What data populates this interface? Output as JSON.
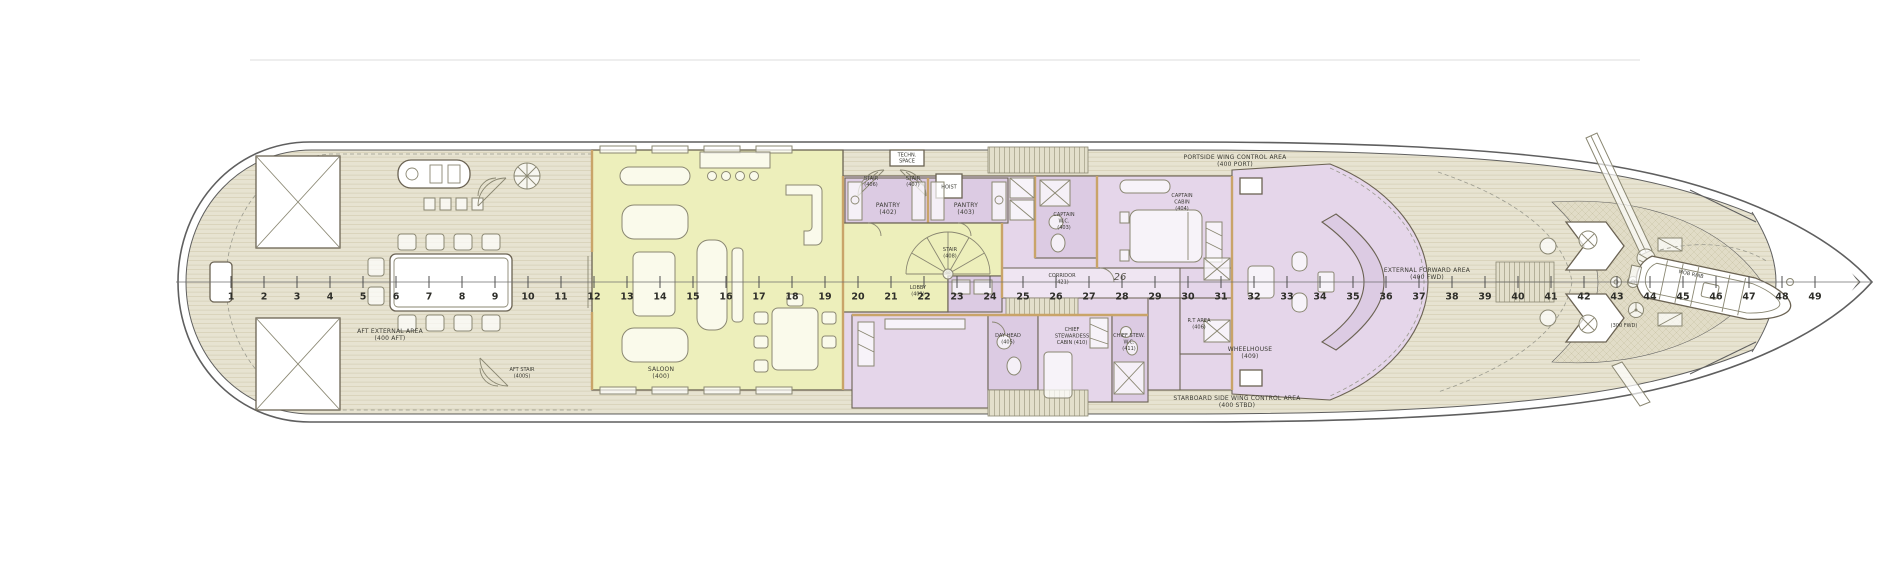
{
  "plan": {
    "type": "yacht-deck-general-arrangement",
    "deck_series": "400"
  },
  "colors": {
    "background": "#ffffff",
    "hull_line": "#5f5f5f",
    "deck_teak": "#e7e3d1",
    "deck_plank_line": "#d5cfb6",
    "foredeck_hatch_fill": "#e1dcc7",
    "foredeck_hatch_line": "#cdc7ab",
    "saloon_fill": "#edefbb",
    "room_pink": "#e5d6ea",
    "room_pink_dark": "#dccbe3",
    "corridor_fill": "#efe5f2",
    "wall_line": "#6b6353",
    "wall_accent": "#c9a469",
    "furniture_line": "#8a8772",
    "text_color": "#3a3a33",
    "frame_text": "#2e2e29"
  },
  "frames": {
    "numbers": [
      1,
      2,
      3,
      4,
      5,
      6,
      7,
      8,
      9,
      10,
      11,
      12,
      13,
      14,
      15,
      16,
      17,
      18,
      19,
      20,
      21,
      22,
      23,
      24,
      25,
      26,
      27,
      28,
      29,
      30,
      31,
      32,
      33,
      34,
      35,
      36,
      37,
      38,
      39,
      40,
      41,
      42,
      43,
      44,
      45,
      46,
      47,
      48,
      49
    ]
  },
  "labels": {
    "aft_external": {
      "l1": "AFT EXTERNAL AREA",
      "l2": "(400 AFT)"
    },
    "aft_stair": {
      "l1": "AFT STAIR",
      "l2": "(400S)"
    },
    "saloon": {
      "l1": "SALOON",
      "l2": "(400)"
    },
    "stair_port_1": {
      "l1": "STAIR",
      "l2": "(406)"
    },
    "stair_port_2": {
      "l1": "STAIR",
      "l2": "(407)"
    },
    "techn_space": {
      "l1": "TECHN.",
      "l2": "SPACE"
    },
    "hoist": {
      "l1": "HOIST"
    },
    "pantry_port": {
      "l1": "PANTRY",
      "l2": "(402)"
    },
    "pantry_stbd": {
      "l1": "PANTRY",
      "l2": "(403)"
    },
    "stair_spiral": {
      "l1": "STAIR",
      "l2": "(408)"
    },
    "lobby": {
      "l1": "LOBBY",
      "l2": "(401)"
    },
    "corridor": {
      "l1": "CORRIDOR",
      "l2": "(421)"
    },
    "day_head": {
      "l1": "DAY HEAD",
      "l2": "(405)"
    },
    "chief_stew_cabin": {
      "l1": "CHIEF",
      "l2": "STEWARDESS",
      "l3": "CABIN (410)"
    },
    "chief_stew_wc": {
      "l1": "CHIEF STEW.",
      "l2": "W.C.",
      "l3": "(411)"
    },
    "captain_wc": {
      "l1": "CAPTAIN",
      "l2": "W.C.",
      "l3": "(403)"
    },
    "captain_cabin": {
      "l1": "CAPTAIN",
      "l2": "CABIN",
      "l3": "(404)"
    },
    "rt_area": {
      "l1": "R.T AREA",
      "l2": "(406)"
    },
    "wheelhouse": {
      "l1": "WHEELHOUSE",
      "l2": "(409)"
    },
    "port_wing": {
      "l1": "PORTSIDE WING CONTROL AREA",
      "l2": "(400 PORT)"
    },
    "stbd_wing": {
      "l1": "STARBOARD SIDE WING CONTROL AREA",
      "l2": "(400 STBD)"
    },
    "external_forward": {
      "l1": "EXTERNAL FORWARD AREA",
      "l2": "(400 FWD)"
    },
    "fwd_300": {
      "l1": "(300 FWD)"
    },
    "mob_rhib": {
      "l1": "MOB RHIB"
    },
    "frame_26_note": {
      "l1": "26"
    }
  }
}
